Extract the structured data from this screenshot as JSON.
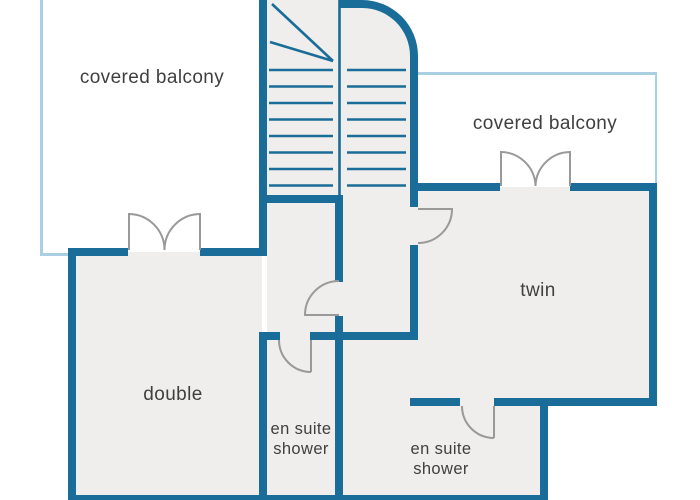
{
  "plan": {
    "type": "floor-plan",
    "rooms": [
      {
        "id": "balcony-left",
        "label": "covered balcony"
      },
      {
        "id": "balcony-right",
        "label": "covered balcony"
      },
      {
        "id": "double-bedroom",
        "label": "double"
      },
      {
        "id": "twin-bedroom",
        "label": "twin"
      },
      {
        "id": "ensuite-left",
        "label": "en suite shower"
      },
      {
        "id": "ensuite-right",
        "label": "en suite shower"
      }
    ],
    "features": [
      "staircase",
      "french-doors",
      "door-swings"
    ],
    "colors": {
      "wall": "#1a6d98",
      "balcony_outline": "#abcfe2",
      "floor": "#f0eeec",
      "door": "#999999",
      "text": "#3f3f3f",
      "background": "#ffffff"
    }
  }
}
